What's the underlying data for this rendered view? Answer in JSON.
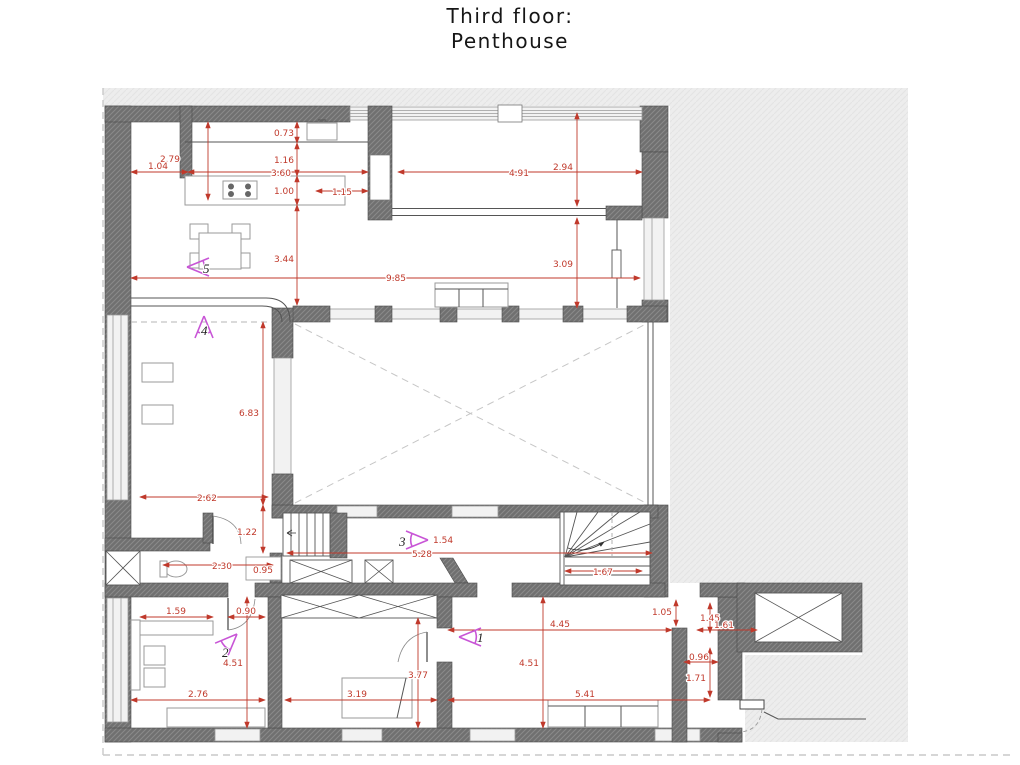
{
  "title": {
    "line1": "Third floor:",
    "line2": "Penthouse"
  },
  "colors": {
    "dimension_red": "#c0392b",
    "camera_magenta": "#c855d6",
    "wall_gray": "#6f6f6f",
    "outside_gray": "#ececec"
  },
  "dimensions": {
    "d073": "0.73",
    "d116": "1.16",
    "d360": "3.60",
    "d100": "1.00",
    "d115": "1.15",
    "d279": "2.79",
    "d104": "1.04",
    "d344": "3.44",
    "d985": "9.85",
    "d491": "4.91",
    "d294": "2.94",
    "d309": "3.09",
    "d683": "6.83",
    "d262": "2.62",
    "d122": "1.22",
    "d154": "1.54",
    "d528": "5.28",
    "d230": "2.30",
    "d095": "0.95",
    "d167": "1.67",
    "d159": "1.59",
    "d090": "0.90",
    "d451L": "4.51",
    "d276": "2.76",
    "d319": "3.19",
    "d377": "3.77",
    "d445": "4.45",
    "d451R": "4.51",
    "d541": "5.41",
    "d105": "1.05",
    "d145": "1.45",
    "d161": "1.61",
    "d096": "0.96",
    "d171": "1.71"
  },
  "cameras": {
    "c1": "1",
    "c2": "2",
    "c3": "3",
    "c4": "4",
    "c5": "5"
  }
}
